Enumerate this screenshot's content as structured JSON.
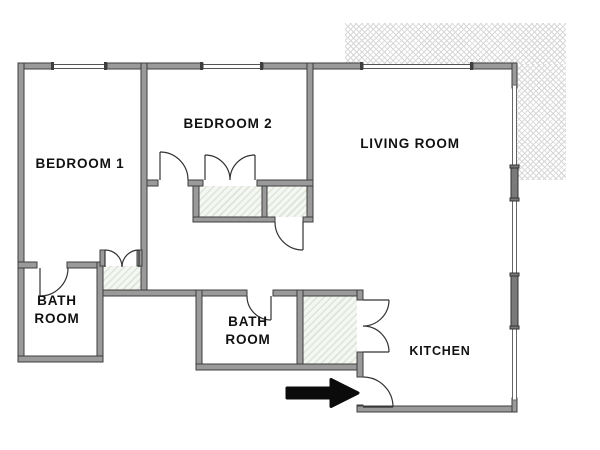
{
  "plan": {
    "rooms": {
      "bedroom1": {
        "label": "BEDROOM 1"
      },
      "bedroom2": {
        "label": "BEDROOM 2"
      },
      "living_room": {
        "label": "LIVING ROOM"
      },
      "bathroom1": {
        "line1": "BATH",
        "line2": "ROOM"
      },
      "bathroom2": {
        "line1": "BATH",
        "line2": "ROOM"
      },
      "kitchen": {
        "label": "KITCHEN"
      }
    },
    "icons": {
      "entrance_arrow": "entrance-arrow-right"
    },
    "colors": {
      "wall_fill": "#9a9a9a",
      "wall_edge": "#3e3e3e",
      "door_line": "#333333",
      "window_block": "#7a7a7a",
      "closet_hatch_line": "#dde5d8",
      "closet_hatch_bg": "#f5f7f2",
      "patio_hatch_line": "#d7d7d7",
      "label_text": "#111111",
      "arrow": "#0b0b0b"
    }
  }
}
